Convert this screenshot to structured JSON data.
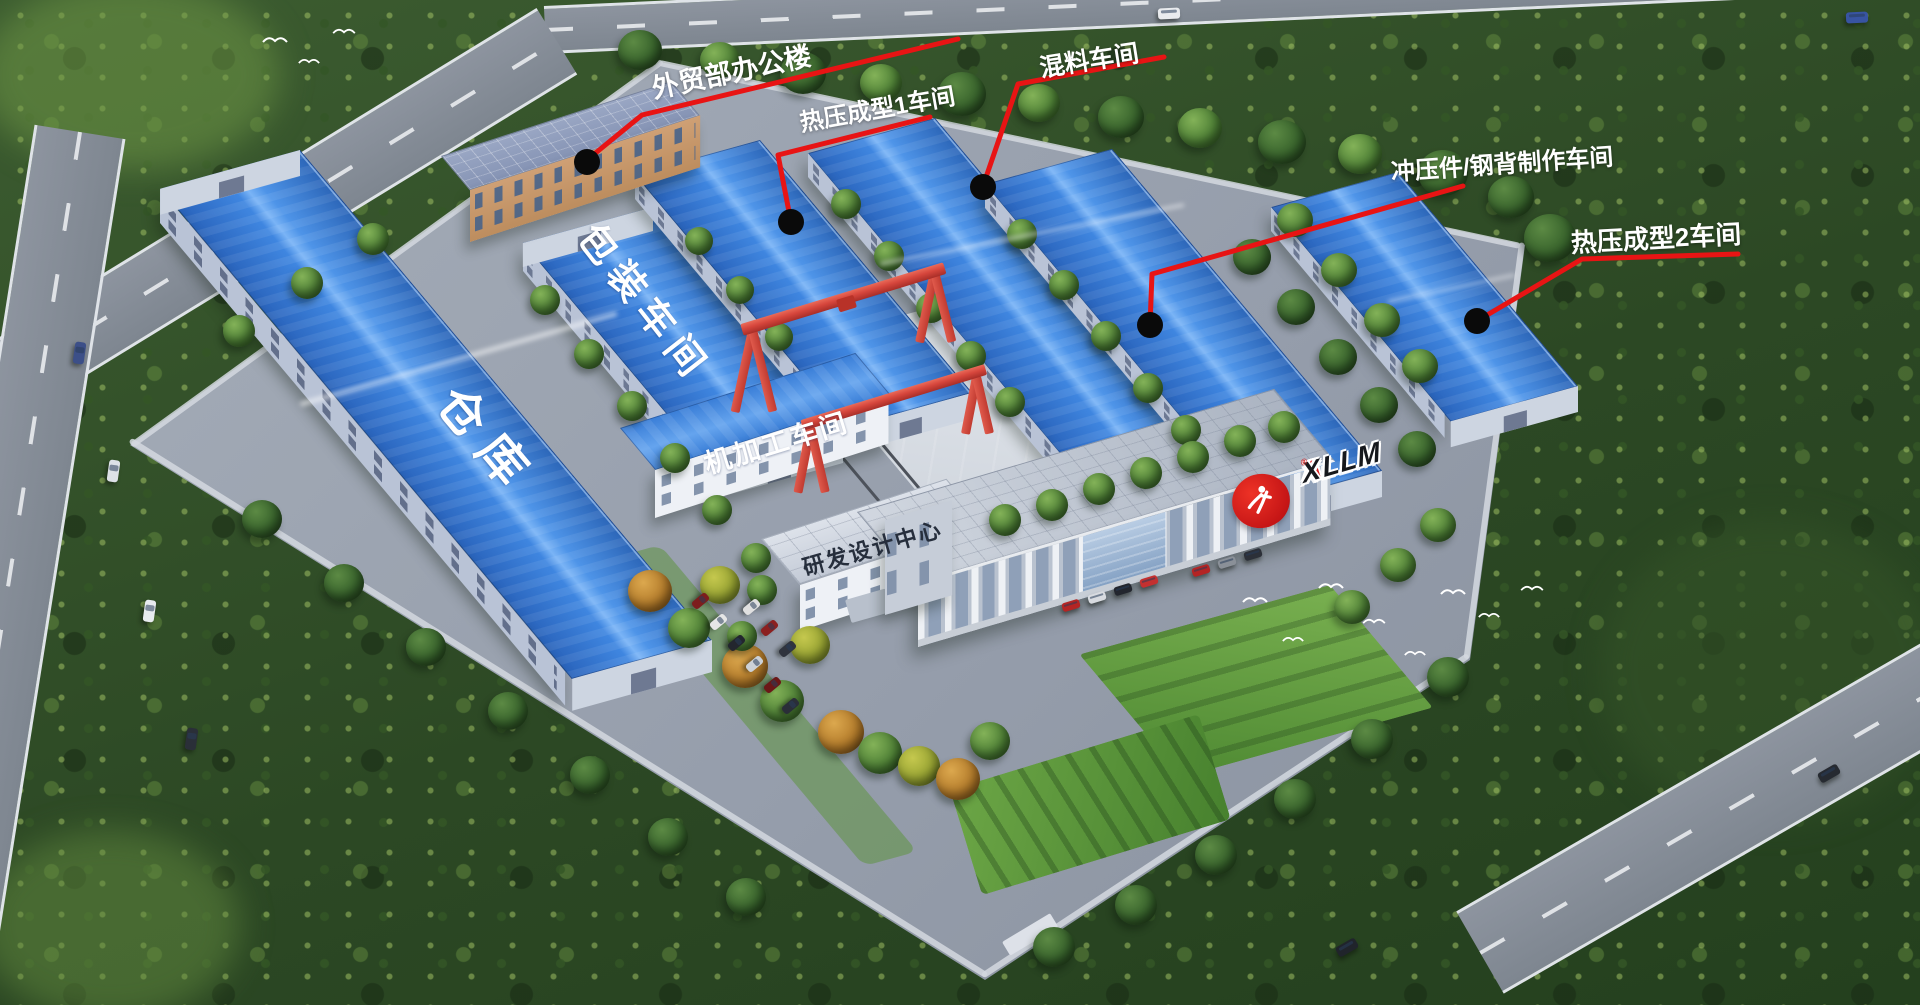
{
  "callouts": [
    {
      "label": "外贸部办公楼"
    },
    {
      "label": "热压成型1车间"
    },
    {
      "label": "混料车间"
    },
    {
      "label": "冲压件/钢背制作车间"
    },
    {
      "label": "热压成型2车间"
    }
  ],
  "roof_labels": {
    "warehouse": "仓库",
    "packaging": "包装车间",
    "machining": "机加工车间",
    "rnd": "研发设计中心"
  },
  "logo": {
    "part1": "ALLM",
    "part2": "A",
    "part3": "X",
    "registered": "®"
  },
  "colors": {
    "callout_line": "#e81414",
    "callout_dot": "#0a0a0a",
    "roof_blue": "#3b82dc",
    "label_text": "#ffffff",
    "logo_red": "#d62222"
  }
}
